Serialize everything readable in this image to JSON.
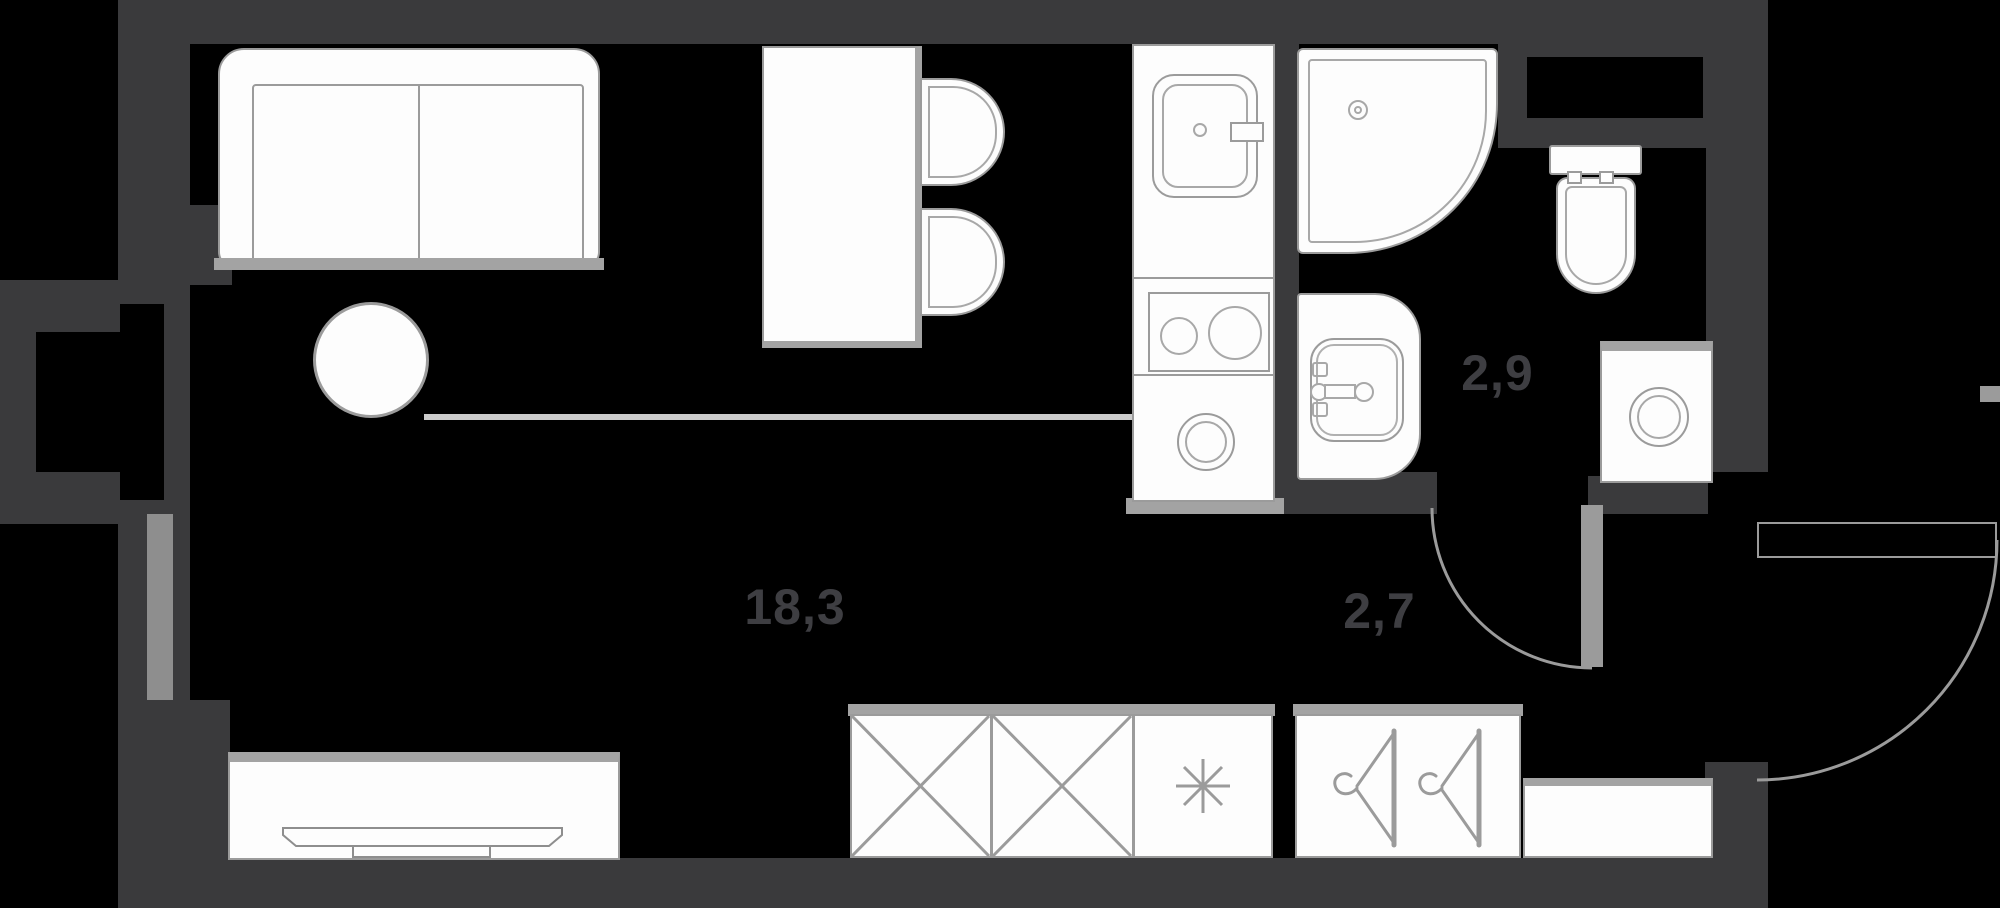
{
  "plan": {
    "title": "Studio apartment floor plan",
    "rooms": [
      {
        "name": "living-kitchen",
        "area_label": "18,3"
      },
      {
        "name": "bathroom",
        "area_label": "2,9"
      },
      {
        "name": "hallway",
        "area_label": "2,7"
      }
    ],
    "fixtures": [
      "sofa",
      "round-table",
      "bar-table",
      "bar-stool",
      "kitchen-sink",
      "cooktop",
      "kitchen-round-appliance",
      "corner-shower",
      "toilet",
      "vanity-sink",
      "washing-machine",
      "tv-stand",
      "tv",
      "wardrobe-section",
      "refrigerator-asterisk",
      "hanger-closet",
      "shelf-cabinet",
      "window-bay",
      "entrance-door",
      "bathroom-door"
    ],
    "colors": {
      "background": "#000000",
      "wall": "#3a3a3c",
      "fixture_fill": "#fdfdfd",
      "fixture_stroke": "#9b9b9b",
      "accent_gray": "#a3a3a3",
      "label_text": "#3e3e42"
    }
  }
}
